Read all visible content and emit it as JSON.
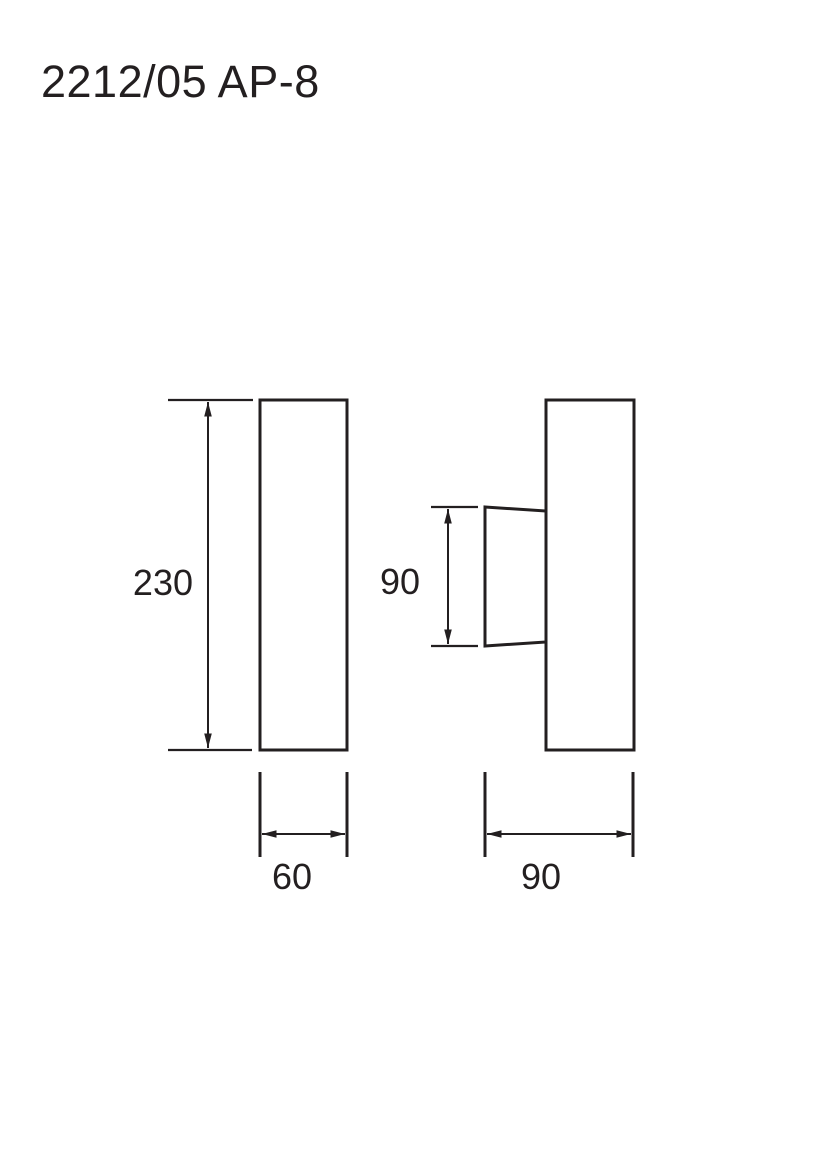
{
  "title": "2212/05 AP-8",
  "colors": {
    "line": "#231f20",
    "background": "#ffffff"
  },
  "views": {
    "front": {
      "height_dim": "230",
      "width_dim": "60"
    },
    "side": {
      "shade_height_dim": "90",
      "depth_dim": "90"
    }
  }
}
